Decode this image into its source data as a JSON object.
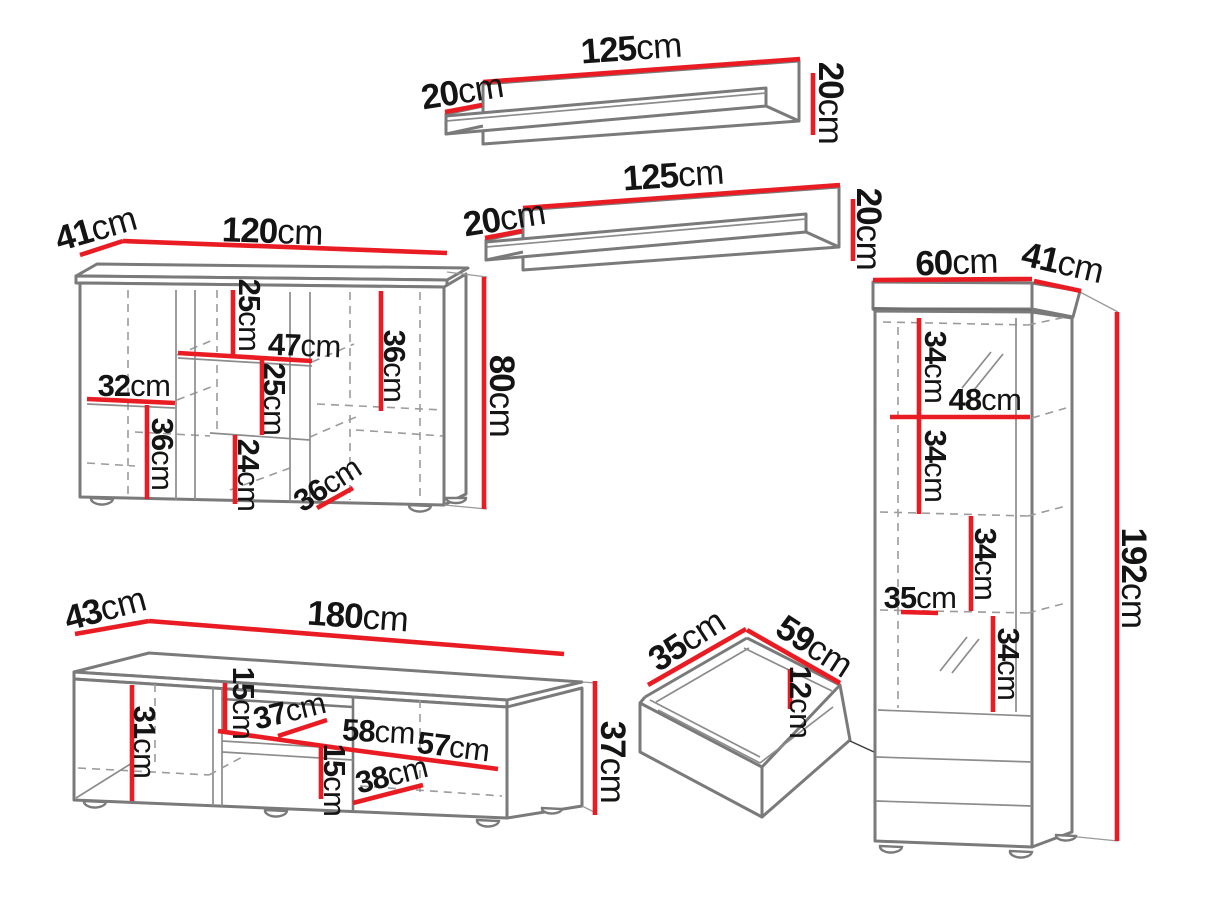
{
  "palette": {
    "dimension_red": "#ea1c23",
    "outline_grey": "#7a7a7a",
    "hidden_line_grey": "#9b9b9b",
    "label_color": "#141414",
    "background": "#ffffff"
  },
  "shelf_top": {
    "width": {
      "v": "125",
      "u": "cm"
    },
    "depth": {
      "v": "20",
      "u": "cm"
    },
    "height": {
      "v": "20",
      "u": "cm"
    }
  },
  "shelf_middle": {
    "width": {
      "v": "125",
      "u": "cm"
    },
    "depth": {
      "v": "20",
      "u": "cm"
    },
    "height": {
      "v": "20",
      "u": "cm"
    }
  },
  "sideboard": {
    "depth": {
      "v": "41",
      "u": "cm"
    },
    "width": {
      "v": "120",
      "u": "cm"
    },
    "height": {
      "v": "80",
      "u": "cm"
    },
    "inner": [
      {
        "v": "25",
        "u": "cm"
      },
      {
        "v": "47",
        "u": "cm"
      },
      {
        "v": "36",
        "u": "cm"
      },
      {
        "v": "32",
        "u": "cm"
      },
      {
        "v": "25",
        "u": "cm"
      },
      {
        "v": "36",
        "u": "cm"
      },
      {
        "v": "24",
        "u": "cm"
      },
      {
        "v": "36",
        "u": "cm"
      }
    ]
  },
  "tv_stand": {
    "depth": {
      "v": "43",
      "u": "cm"
    },
    "width": {
      "v": "180",
      "u": "cm"
    },
    "height": {
      "v": "37",
      "u": "cm"
    },
    "inner": [
      {
        "v": "31",
        "u": "cm"
      },
      {
        "v": "15",
        "u": "cm"
      },
      {
        "v": "37",
        "u": "cm"
      },
      {
        "v": "58",
        "u": "cm"
      },
      {
        "v": "57",
        "u": "cm"
      },
      {
        "v": "15",
        "u": "cm"
      },
      {
        "v": "38",
        "u": "cm"
      }
    ]
  },
  "drawer": {
    "depth": {
      "v": "35",
      "u": "cm"
    },
    "width": {
      "v": "59",
      "u": "cm"
    },
    "height": {
      "v": "12",
      "u": "cm"
    }
  },
  "tall_cabinet": {
    "width": {
      "v": "60",
      "u": "cm"
    },
    "depth": {
      "v": "41",
      "u": "cm"
    },
    "height": {
      "v": "192",
      "u": "cm"
    },
    "inner": [
      {
        "v": "34",
        "u": "cm"
      },
      {
        "v": "48",
        "u": "cm"
      },
      {
        "v": "34",
        "u": "cm"
      },
      {
        "v": "34",
        "u": "cm"
      },
      {
        "v": "35",
        "u": "cm"
      },
      {
        "v": "34",
        "u": "cm"
      }
    ]
  }
}
